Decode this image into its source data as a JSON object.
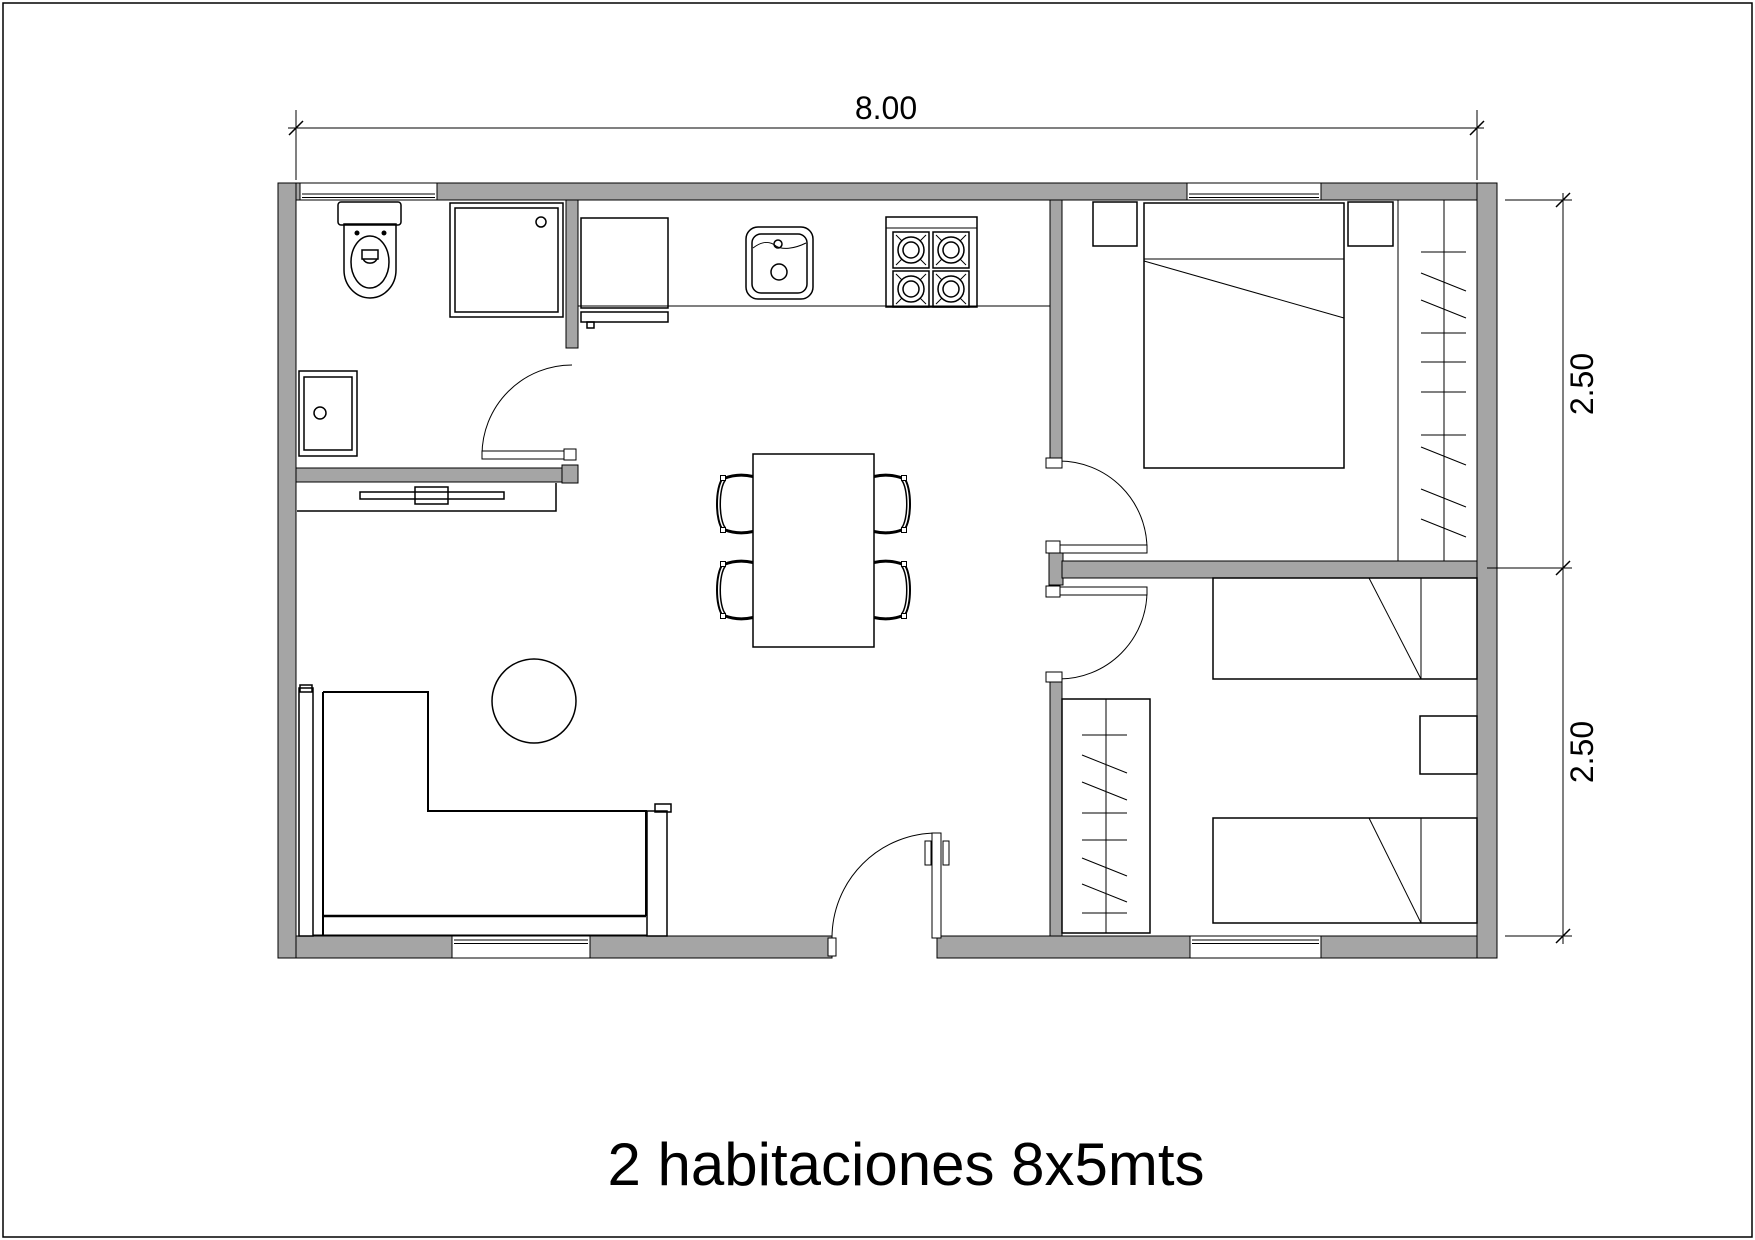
{
  "title": {
    "text": "2 habitaciones 8x5mts"
  },
  "dimensions": {
    "top_width": "8.00",
    "right_upper": "2.50",
    "right_lower": "2.50"
  },
  "colors": {
    "wall_fill": "#a5a5a5",
    "line": "#000000",
    "background": "#ffffff"
  },
  "symbols": [
    "toilet",
    "shower",
    "bathroom-sink",
    "refrigerator",
    "kitchen-sink",
    "stove-4-burners",
    "kitchen-counter",
    "dining-table",
    "chair",
    "l-shaped-sofa",
    "round-table",
    "console-shelf",
    "double-bed",
    "single-bed",
    "nightstand",
    "closet-rail",
    "swing-door",
    "window"
  ]
}
